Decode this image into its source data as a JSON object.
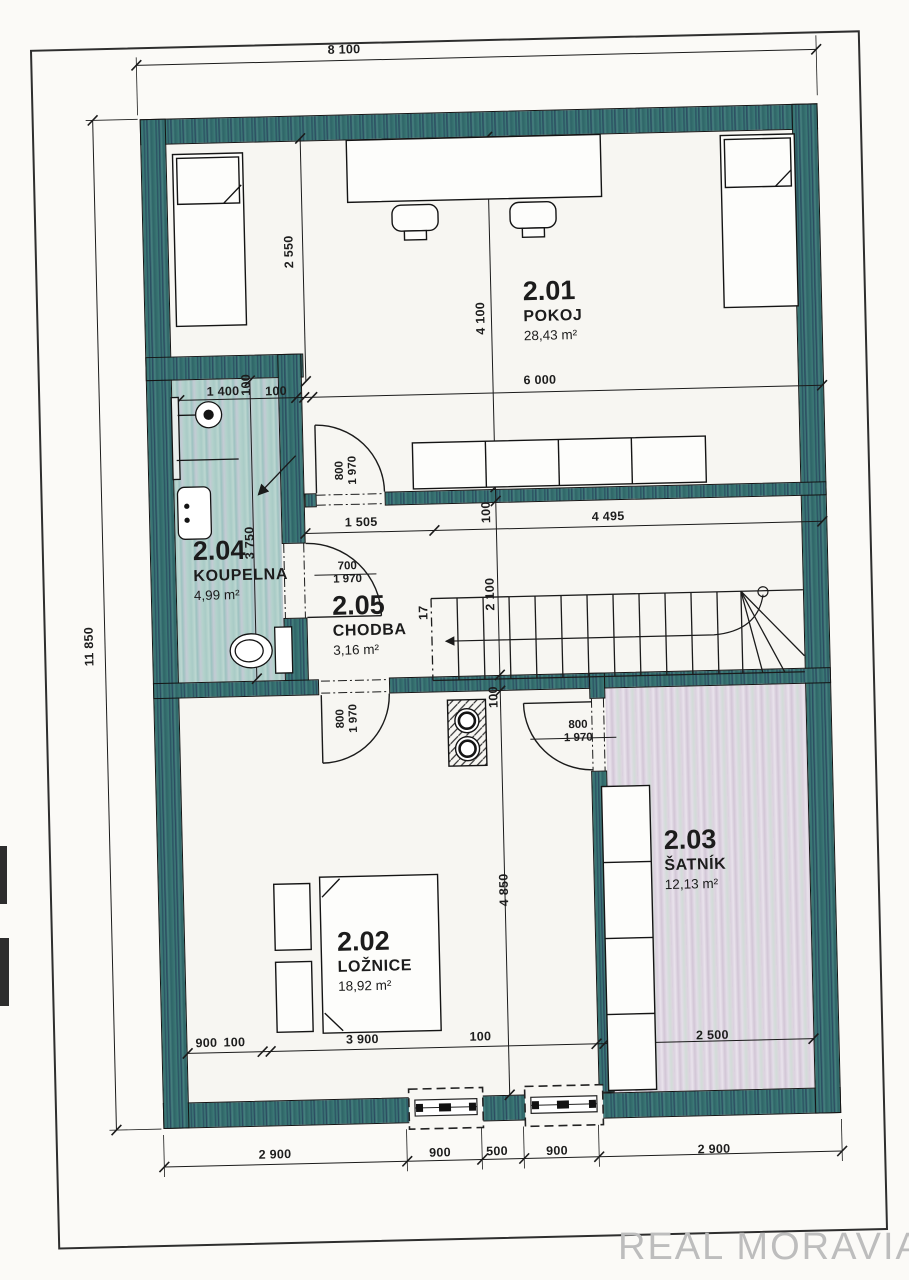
{
  "watermark": {
    "text": "REAL MORAVIA"
  },
  "rooms": [
    {
      "id": "2.01",
      "name": "POKOJ",
      "area": "28,43 m²"
    },
    {
      "id": "2.02",
      "name": "LOŽNICE",
      "area": "18,92 m²"
    },
    {
      "id": "2.03",
      "name": "ŠATNÍK",
      "area": "12,13 m²"
    },
    {
      "id": "2.04",
      "name": "KOUPELNA",
      "area": "4,99 m²"
    },
    {
      "id": "2.05",
      "name": "CHODBA",
      "area": "3,16 m²"
    }
  ],
  "dims": {
    "w8100": "8 100",
    "h11850": "11 850",
    "d6000": "6 000",
    "d4100": "4 100",
    "d2550": "2 550",
    "d1400": "1 400",
    "d100": "100",
    "d3750": "3 750",
    "d1505": "1 505",
    "d4495": "4 495",
    "d2100": "2 100",
    "steps": "17",
    "d700": "700",
    "d800": "800",
    "d1970": "1 970",
    "d4850": "4 850",
    "d900": "900",
    "d3900": "3 900",
    "d2500": "2 500",
    "d2900": "2 900",
    "d500": "500"
  },
  "colors": {
    "wall": "#35706e",
    "bath_floor": "#aecdc9",
    "closet_floor": "#ddd3e0",
    "paper": "#f7f5f1",
    "line": "#1c1c1c",
    "watermark_text": "#bdbdbd"
  }
}
